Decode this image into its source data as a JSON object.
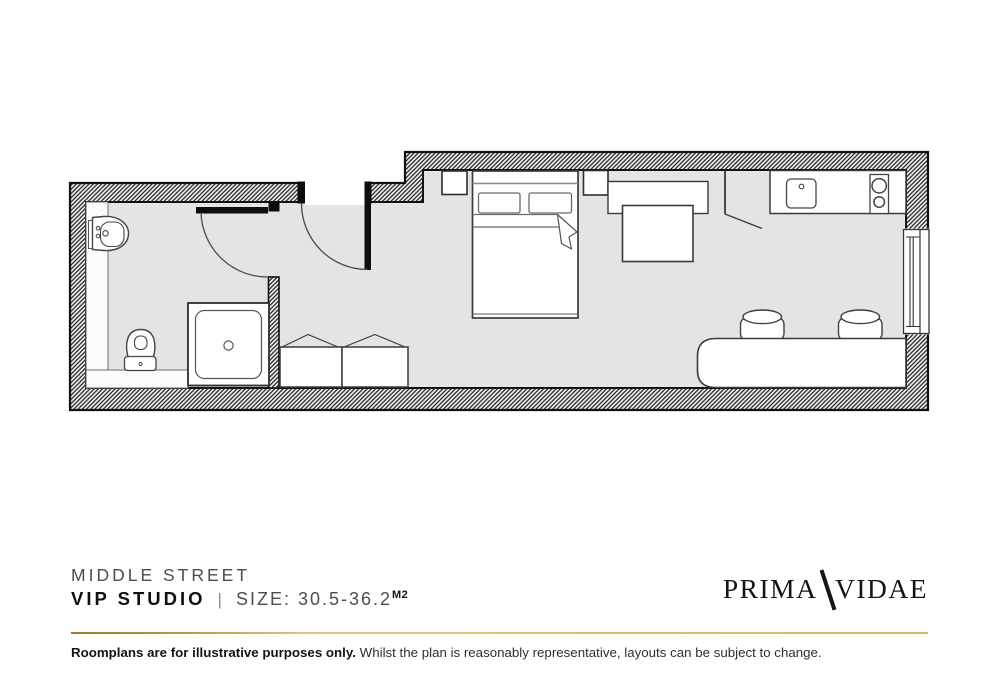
{
  "header": {
    "development_name": "MIDDLE STREET",
    "unit_name": "VIP STUDIO",
    "separator": "|",
    "size_label": "SIZE: 30.5-36.2",
    "size_unit": "M2"
  },
  "logo": {
    "part1": "PRIMA",
    "part2": "VIDAE"
  },
  "footer": {
    "disclaimer_bold": "Roomplans are for illustrative purposes only.",
    "disclaimer_rest": " Whilst the plan is reasonably representative, layouts can be subject to change."
  },
  "colors": {
    "accent_gold": "#c9a75c",
    "wall_line": "#111111",
    "floor_fill": "#e4e4e4",
    "furniture_fill": "#ffffff"
  },
  "plan": {
    "type": "studio-floorplan",
    "elements": [
      "outer-hatched-walls",
      "entrance-door",
      "bathroom-door",
      "bathroom-sink",
      "toilet",
      "shower-tray",
      "bathroom-partition",
      "wardrobe-left",
      "wardrobe-right",
      "nightstand-left",
      "double-bed",
      "pillows",
      "nightstand-right",
      "sideboard",
      "table",
      "kitchen-partition",
      "kitchen-counter",
      "kitchen-sink",
      "hob",
      "window",
      "desk",
      "desk-chair-1",
      "desk-chair-2"
    ]
  }
}
